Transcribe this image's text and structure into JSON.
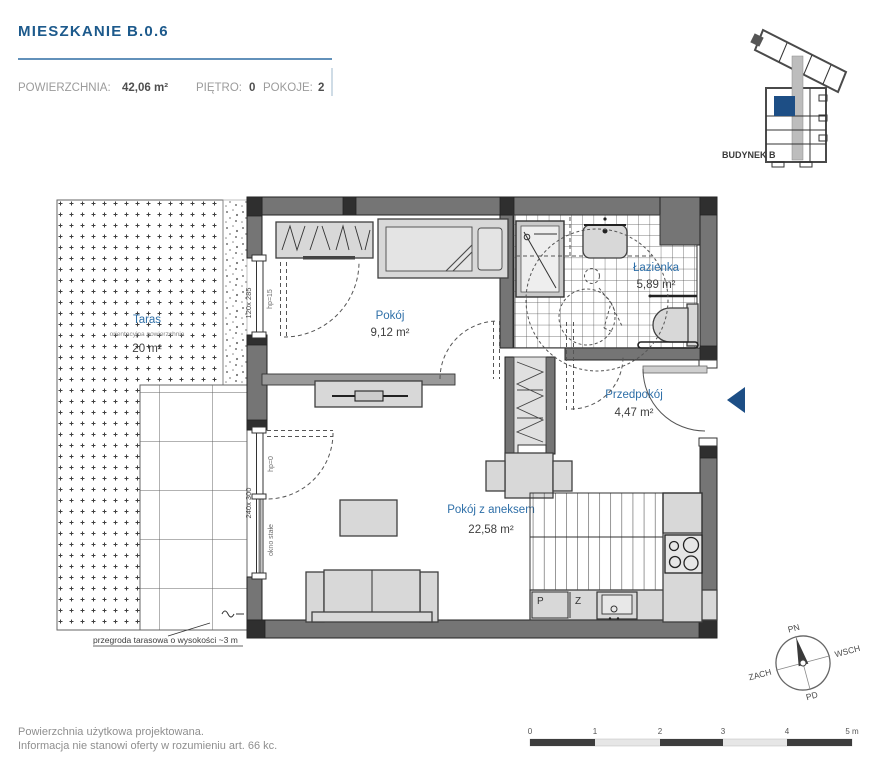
{
  "header": {
    "title": "MIESZKANIE",
    "unit": "B.0.6",
    "area_label": "POWIERZCHNIA:",
    "area_value": "42,06 m²",
    "floor_label": "PIĘTRO:",
    "floor_value": "0",
    "rooms_label": "POKOJE:",
    "rooms_value": "2"
  },
  "minimap": {
    "building_label": "BUDYNEK B"
  },
  "rooms": {
    "bedroom": {
      "name": "Pokój",
      "area": "9,12 m²"
    },
    "bathroom": {
      "name": "Łazienka",
      "area": "5,89 m²"
    },
    "hall": {
      "name": "Przedpokój",
      "area": "4,47 m²"
    },
    "living": {
      "name": "Pokój z aneksem",
      "area": "22,58 m²"
    },
    "terrace": {
      "name": "Taras",
      "note": "orientacyjna powierzchnia",
      "area": "20 m²"
    }
  },
  "annotations": {
    "window_upper_size": "120x 285",
    "window_upper_hp": "hp=15",
    "window_lower_size": "240x 300",
    "window_lower_hp": "hp=0",
    "window_lower_type": "okno stałe",
    "terrace_note": "przegroda tarasowa o wysokości ~3 m",
    "washer": "P",
    "dishwasher": "Z"
  },
  "compass": {
    "north": "PN",
    "east": "WSCH",
    "south": "PD",
    "west": "ZACH"
  },
  "scalebar": {
    "ticks": [
      "0",
      "1",
      "2",
      "3",
      "4"
    ],
    "end_label": "5 m"
  },
  "footer": {
    "line1": "Powierzchnia użytkowa projektowana.",
    "line2": "Informacja nie stanowi oferty w rozumieniu art. 66 kc."
  },
  "colors": {
    "accent_blue": "#1d5a8c",
    "room_label_blue": "#2e6fa8",
    "highlight_blue": "#1d4e85",
    "wall_gray": "#757575"
  }
}
